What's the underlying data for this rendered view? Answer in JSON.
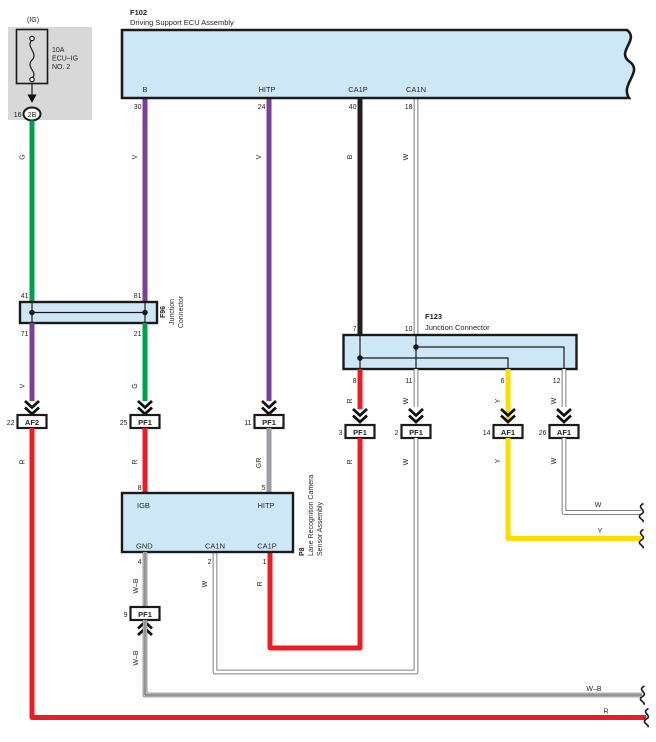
{
  "colors": {
    "green": "#00a14b",
    "violet": "#7b3f98",
    "red": "#ec1c24",
    "yellow": "#ffdc00",
    "gray": "#9c9ea1",
    "black_wire": "#231f20",
    "box_fill": "#cde7f6",
    "fuse_bg": "#d8d8d8"
  },
  "fuse": {
    "header": "(IG)",
    "amps": "10A",
    "name_line1": "ECU–IG",
    "name_line2": "NO. 2",
    "pin": "16",
    "terminal": "2B"
  },
  "ecu": {
    "code": "F102",
    "name": "Driving Support ECU Assembly",
    "pins": {
      "b": {
        "label": "B",
        "num": "30"
      },
      "hitp": {
        "label": "HITP",
        "num": "24"
      },
      "ca1p": {
        "label": "CA1P",
        "num": "40"
      },
      "ca1n": {
        "label": "CA1N",
        "num": "18"
      }
    }
  },
  "f96": {
    "code": "F96",
    "name_line1": "Junction",
    "name_line2": "Connector",
    "pins": {
      "top_left": "41",
      "top_right": "81",
      "bottom_left": "71",
      "bottom_right": "21"
    }
  },
  "f123": {
    "code": "F123",
    "name": "Junction Connector",
    "pins": {
      "top_a": "7",
      "top_b": "10",
      "bottom_a": "8",
      "bottom_b": "11",
      "bottom_c": "6",
      "bottom_d": "12"
    }
  },
  "camera": {
    "code": "P8",
    "name_line1": "Lane Recognition Camera",
    "name_line2": "Sensor Assembly",
    "pins": {
      "igb": {
        "label": "IGB",
        "num": "8"
      },
      "hitp": {
        "label": "HITP",
        "num": "5"
      },
      "gnd": {
        "label": "GND",
        "num": "4"
      },
      "ca1n": {
        "label": "CA1N",
        "num": "2"
      },
      "ca1p": {
        "label": "CA1P",
        "num": "1"
      }
    }
  },
  "connectors": {
    "af2_22": {
      "pin": "22",
      "label": "AF2"
    },
    "pf1_25": {
      "pin": "25",
      "label": "PF1"
    },
    "pf1_11": {
      "pin": "11",
      "label": "PF1"
    },
    "pf1_3": {
      "pin": "3",
      "label": "PF1"
    },
    "pf1_2": {
      "pin": "2",
      "label": "PF1"
    },
    "af1_14": {
      "pin": "14",
      "label": "AF1"
    },
    "af1_26": {
      "pin": "26",
      "label": "AF1"
    },
    "pf1_9": {
      "pin": "9",
      "label": "PF1"
    }
  },
  "wire_labels": {
    "g_fuse": "G",
    "v_ecu_b": "V",
    "v_hitp": "V",
    "b_ca1p": "B",
    "w_ca1n": "W",
    "v_f96": "V",
    "g_f96": "G",
    "r_af2": "R",
    "r_igb": "R",
    "gr_hitp": "GR",
    "r_f123_8": "R",
    "w_f123_11": "W",
    "y_f123_6": "Y",
    "w_f123_12": "W",
    "r_pf1_3": "R",
    "w_pf1_2": "W",
    "y_af1_14": "Y",
    "w_af1_26": "W",
    "r_cam_ca1p": "R",
    "w_cam_ca1n": "W",
    "wb_gnd": "W–B",
    "wb_lower": "W–B",
    "w_right": "W",
    "y_right": "Y",
    "wb_right": "W–B",
    "r_bottom": "R"
  }
}
